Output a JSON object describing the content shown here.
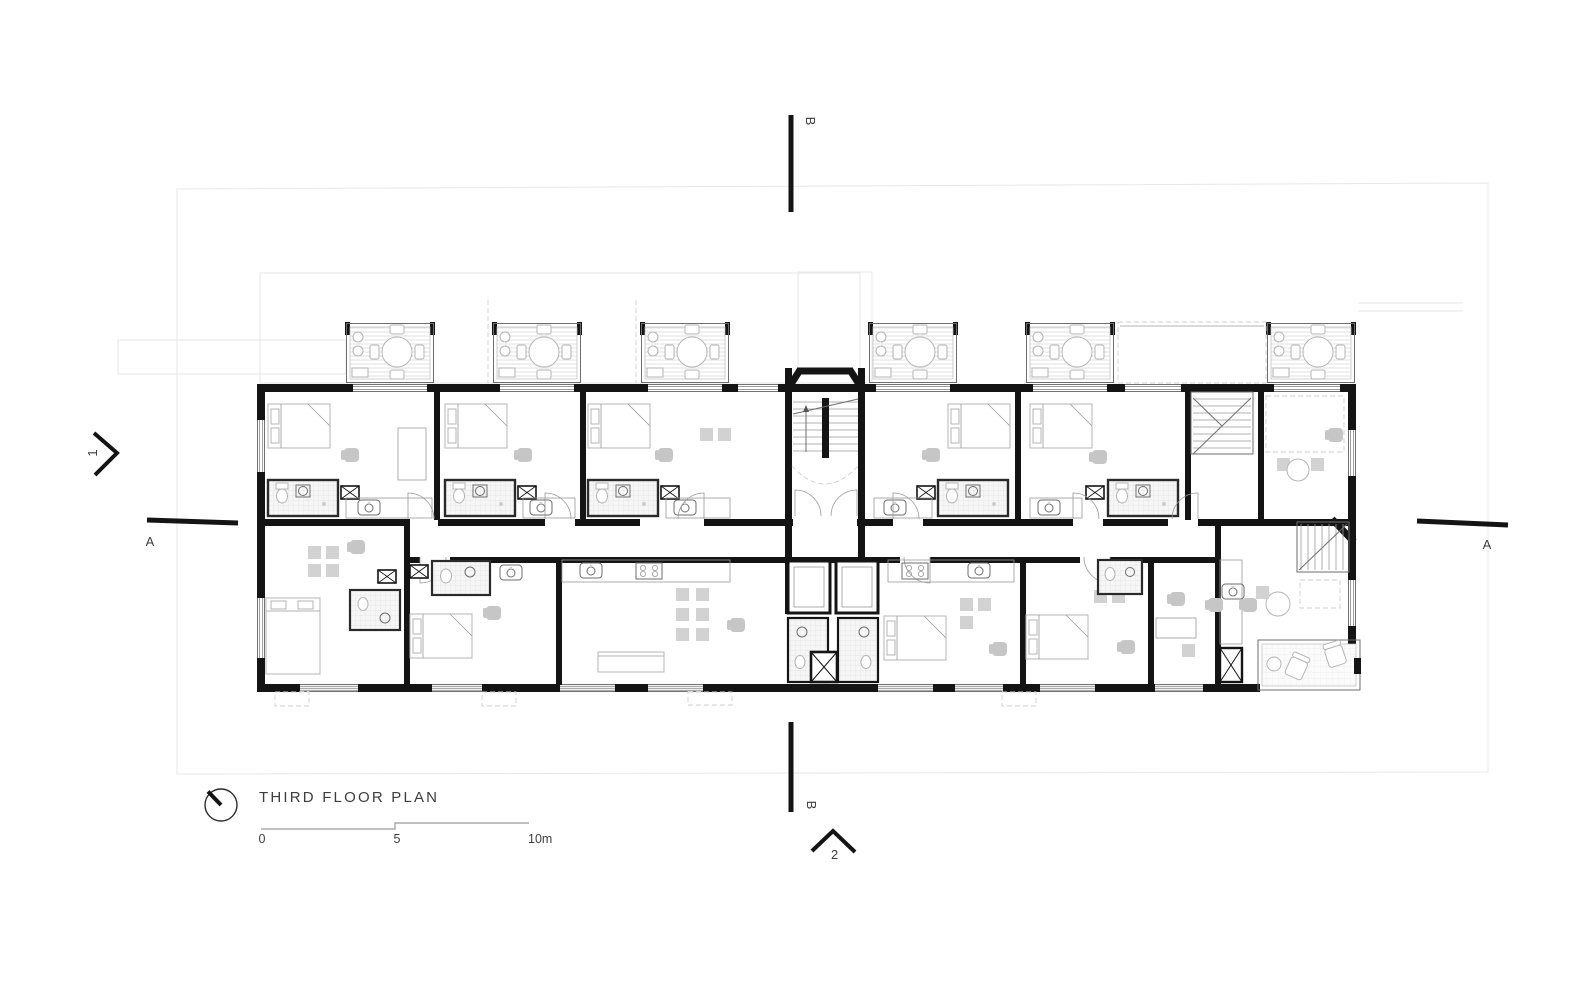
{
  "drawing": {
    "title": "THIRD FLOOR PLAN",
    "scale_bar": {
      "tick_0": "0",
      "tick_5": "5",
      "tick_10": "10m"
    },
    "sections": {
      "top_b": "B",
      "bottom_b": "B",
      "left_a": "A",
      "right_a": "A"
    },
    "elevation_markers": {
      "left": "1",
      "bottom": "2"
    },
    "colors": {
      "wall": "#141414",
      "thin_line": "#6e6e6e",
      "furniture": "#b5b5b5",
      "hatch": "#e0e0e0",
      "boundary": "#e2e2e2",
      "text": "#3d3d3d",
      "background": "#ffffff"
    }
  }
}
